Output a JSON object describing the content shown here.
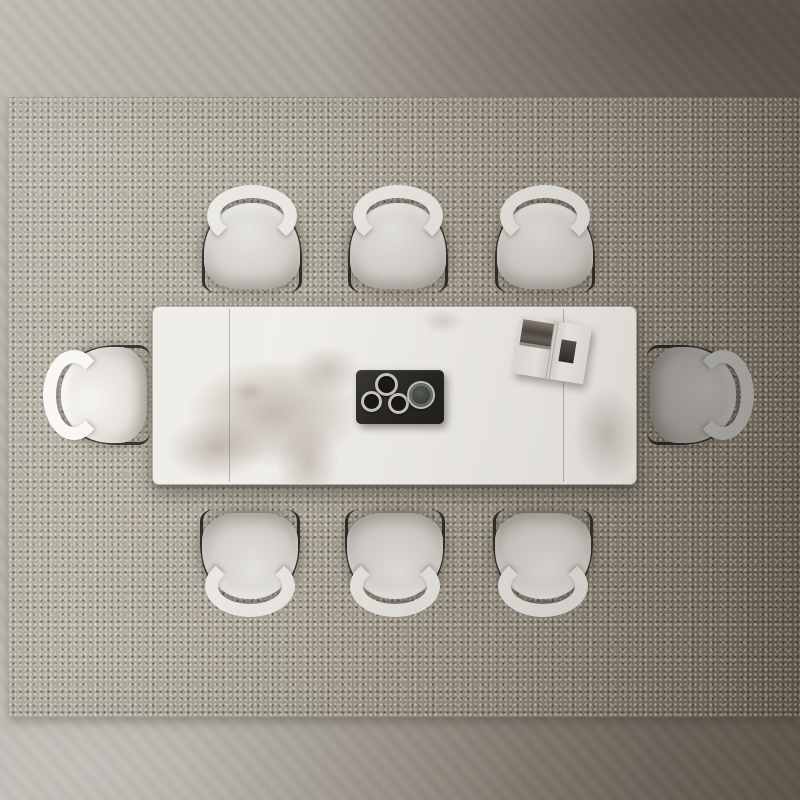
{
  "scene": {
    "view": "top-down product photograph",
    "subject": "eight-seat dining set on a woven area rug over a concrete floor",
    "visible_text": "none"
  },
  "objects": {
    "floor": {
      "label": "concrete floor",
      "shading": "bright lower-left, dark upper-right"
    },
    "rug": {
      "label": "woven flatweave area rug",
      "texture": "fine boucle dot weave",
      "shading": "lighter left, darker right"
    },
    "table": {
      "label": "rectangular dining table",
      "top_material": "white marble / sintered stone with taupe veining",
      "slab_seams": 2,
      "veining_zones": [
        "large patch center-left",
        "patch around book upper-right",
        "patch lower-right edge"
      ]
    },
    "tray": {
      "label": "black rectangular serving tray",
      "contents": [
        "espresso cup",
        "espresso cup",
        "espresso cup",
        "glass tumbler"
      ]
    },
    "book": {
      "label": "open book, photo spread on left page, small image block on right page",
      "rotation_deg": 9
    },
    "chairs": {
      "label": "upholstered dining chair with curved light backrest bar and thin dark frame",
      "count": 8,
      "arrangement": {
        "top_row": 3,
        "bottom_row": 3,
        "left_end": 1,
        "right_end": 1
      },
      "notes": "right-end chair sits in shadow and reads darker; left-end chair is brightest"
    }
  },
  "palette": {
    "floor_light": "#b9b5ae",
    "floor_dark": "#6e6559",
    "rug_light": "#b7b1a5",
    "rug_dark": "#6b6354",
    "table_surface": "#f2f0ec",
    "table_edge": "#b6afa5",
    "marble_vein": "#968a7c",
    "tray": "#272623",
    "cup_rim": "#c9c6c0",
    "cup_well": "#191816",
    "glass_rim": "#c3c7bb",
    "glass_fill": "#3a3f37",
    "chair_seat": "#d5d2cd",
    "chair_seat_hi": "#e6e4e0",
    "chair_seat_lo": "#bcb8b2",
    "chair_back": "#e9e7e2",
    "chair_frame": "#2e2b27",
    "book_page": "#f2f0ec",
    "book_photo": "#4e4841"
  }
}
